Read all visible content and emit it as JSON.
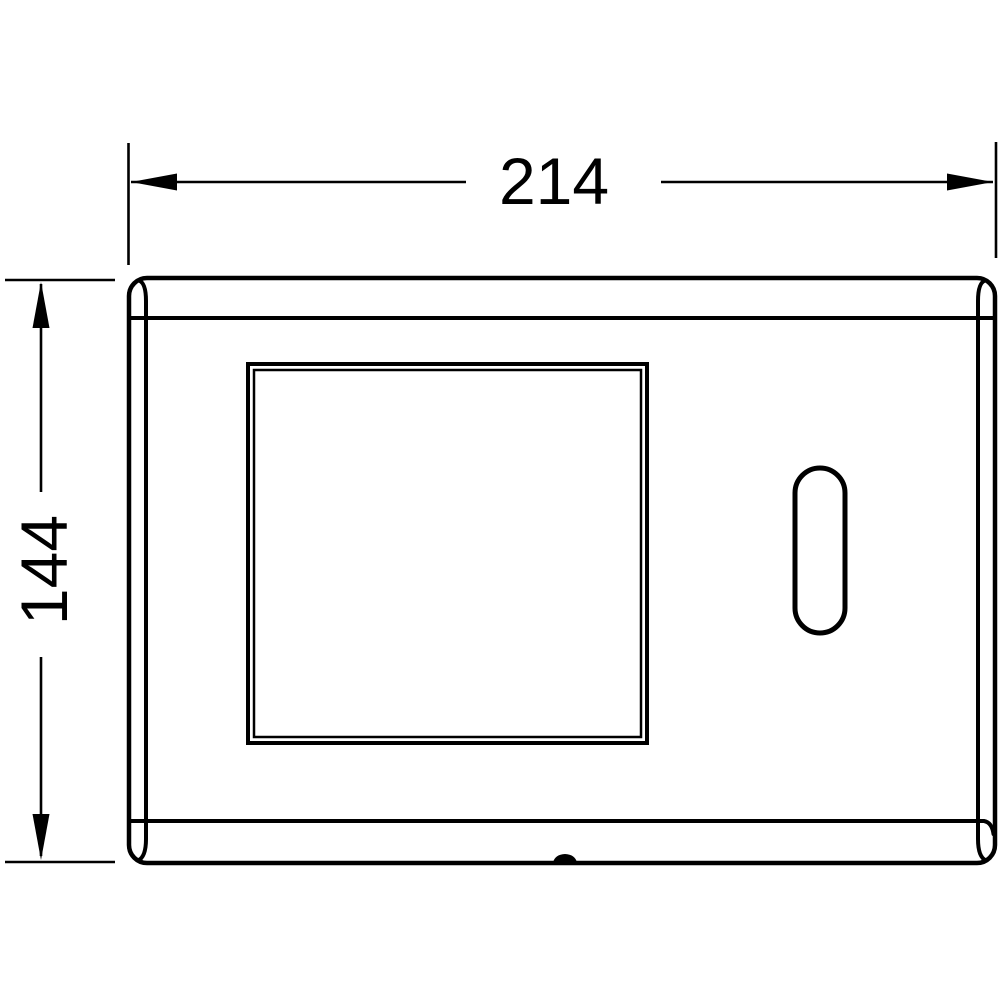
{
  "drawing": {
    "kind": "technical-dimension-drawing",
    "background_color": "#ffffff",
    "line_color": "#000000",
    "parts": {
      "plate": "flush-plate-front-view",
      "window": "square-sensor-window",
      "opening": "oval-sensor-opening",
      "notch": "bottom-center-notch"
    }
  },
  "dimensions": {
    "horizontal": {
      "label": "214"
    },
    "vertical": {
      "label": "144"
    }
  }
}
